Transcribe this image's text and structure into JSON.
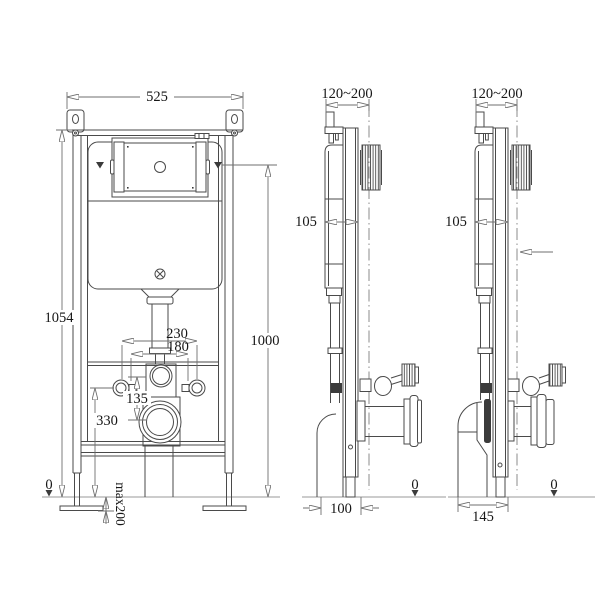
{
  "front": {
    "width": "525",
    "height_left": "1054",
    "height_right": "1000",
    "bolt_spacing_outer": "230",
    "bolt_spacing_inner": "180",
    "flush_to_waste_offset": "135",
    "waste_outlet_height": "330",
    "datum": "0",
    "foot_adjustment": "max200"
  },
  "side_center": {
    "depth_range": "120~200",
    "frame_offset": "105",
    "outlet_distance": "100",
    "datum": "0"
  },
  "side_right": {
    "depth_range": "120~200",
    "frame_offset": "105",
    "outlet_distance": "145",
    "datum": "0"
  },
  "colors": {
    "line": "#4a4a4a",
    "dim": "#6f6f6f",
    "ground": "#9a9a9a",
    "text": "#161616",
    "bg": "#ffffff"
  }
}
